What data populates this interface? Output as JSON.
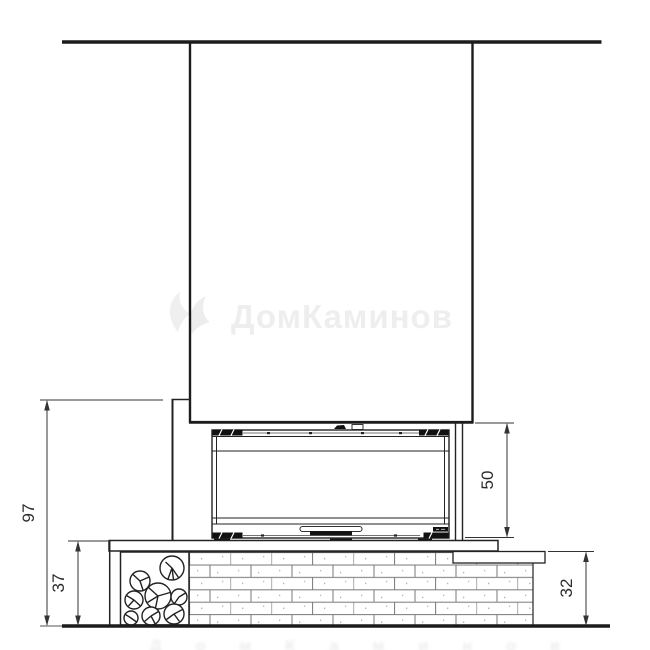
{
  "drawing": {
    "type": "fireplace-front-elevation",
    "style": "black-line technical drawing on white"
  },
  "dimensions": {
    "total_height": "97",
    "bench_height": "37",
    "firebox_height": "50",
    "base_height": "32"
  },
  "watermark": {
    "brand_text": "ДомКаминов"
  },
  "colors": {
    "line": "#222222",
    "dim_line": "#333333",
    "brick_line": "#777777",
    "watermark": "#eeeeee",
    "background": "#ffffff"
  }
}
